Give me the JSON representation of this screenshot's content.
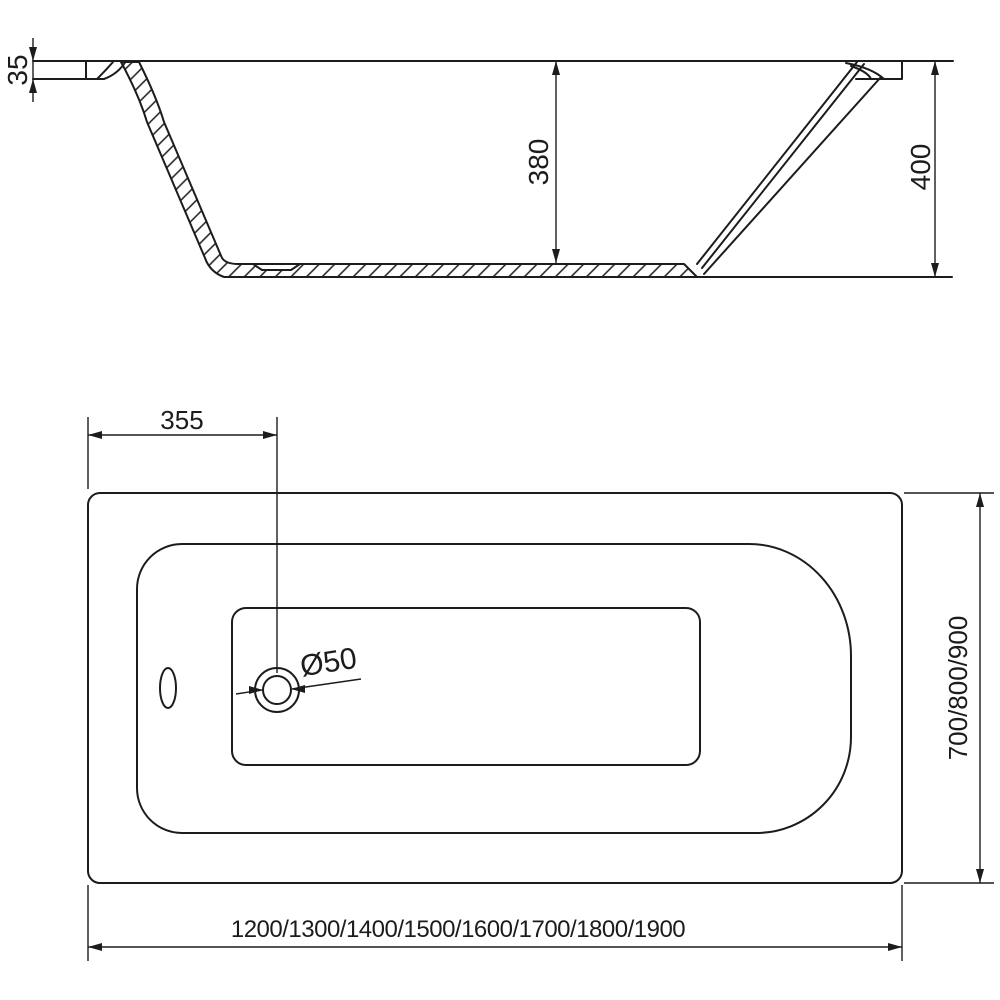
{
  "drawing": {
    "type": "bathtub-technical-drawing",
    "colors": {
      "line": "#1c1c1c",
      "background": "#ffffff"
    },
    "side_view": {
      "rim_thickness_label": "35",
      "inner_depth_label": "380",
      "total_height_label": "400"
    },
    "plan_view": {
      "drain_offset_label": "355",
      "drain_diameter_label": "Ø50",
      "length_options_label": "1200/1300/1400/1500/1600/1700/1800/1900",
      "width_options_label": "700/800/900"
    }
  }
}
